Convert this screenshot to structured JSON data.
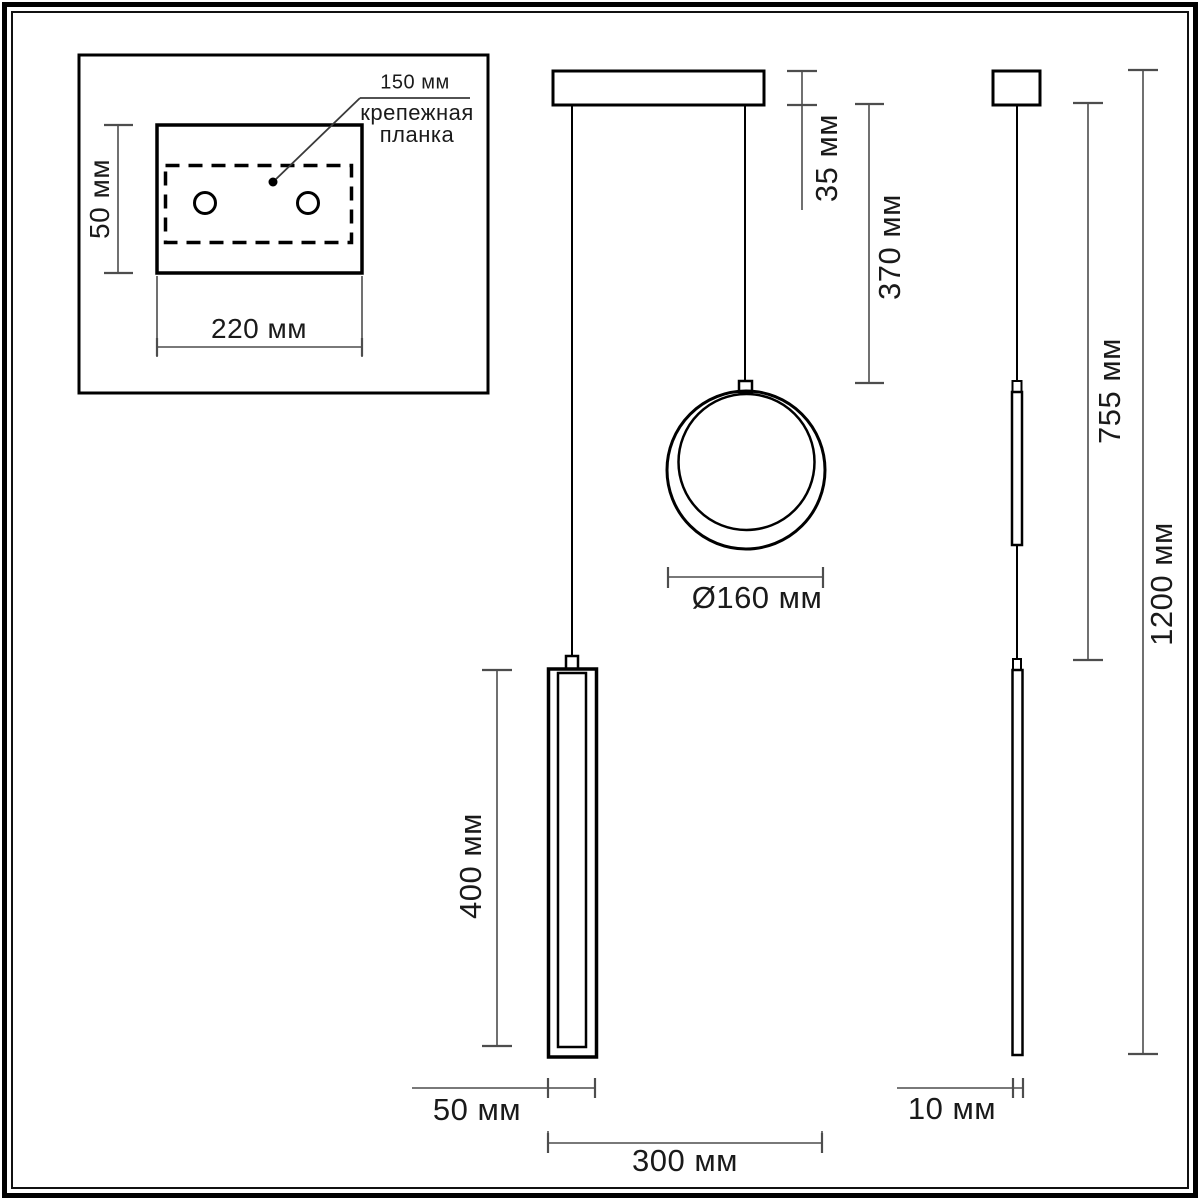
{
  "drawing": {
    "description": "Dimensional line drawing of a two-element pendant light (ring shade and tube shade) with mounting plate inset, front view and side view"
  },
  "inset": {
    "bracket_length_label": "150 мм",
    "bracket_caption_line1": "крепежная",
    "bracket_caption_line2": "планка",
    "plate_height_label": "50 мм",
    "plate_width_label": "220 мм"
  },
  "front_view": {
    "canopy_height_label": "35 мм",
    "suspension_drop_label": "370 мм",
    "ring_diameter_label": "Ø160 мм",
    "tube_length_label": "400 мм",
    "tube_width_label": "50 мм",
    "overall_width_label": "300 мм"
  },
  "side_view": {
    "drop_to_tube_label": "755 мм",
    "overall_height_label": "1200 мм",
    "profile_width_label": "10 мм"
  },
  "colors": {
    "object_line": "#000000",
    "dimension_line": "#4d4d4d",
    "text": "#1a1a1a",
    "background": "#ffffff"
  }
}
